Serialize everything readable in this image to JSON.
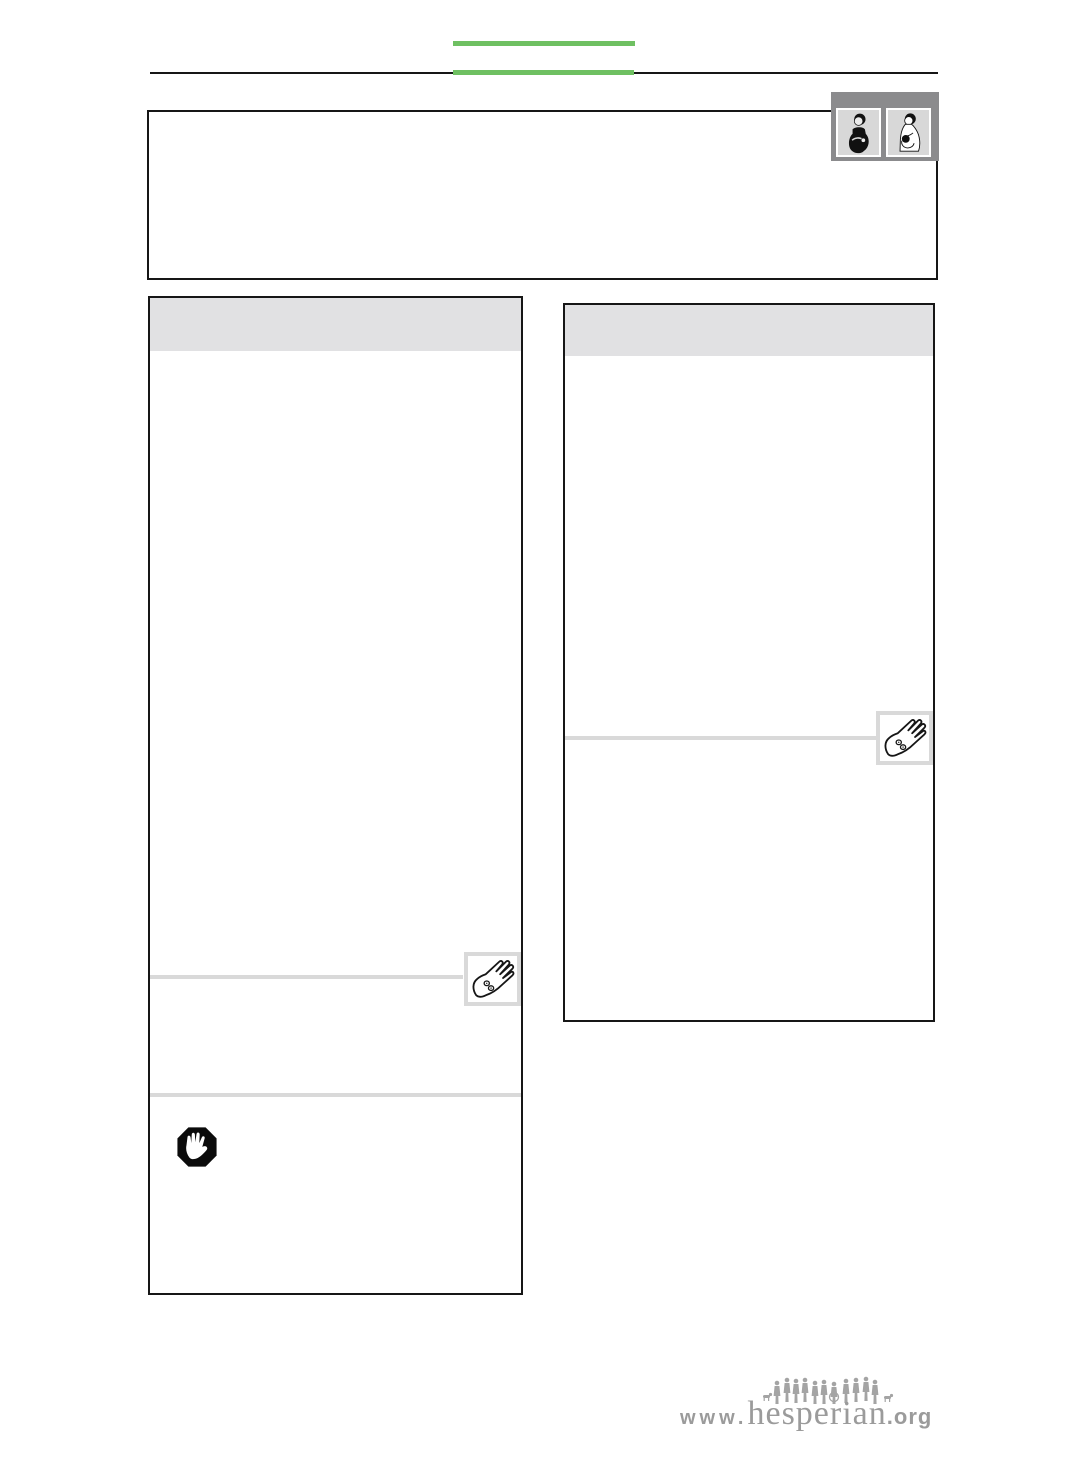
{
  "page": {
    "kind": "blank document page with layout frames",
    "background": "#ffffff"
  },
  "colors": {
    "accent_green": "#6fc062",
    "line_black": "#161616",
    "panel_header_gray": "#e1e1e3",
    "separator_gray": "#d9d9d9",
    "icon_frame_gray": "#d9d9d9",
    "chapter_tab_gray": "#8b8b8d",
    "chapter_tile_gray": "#d8d8d8",
    "logo_gray": "#9b9b9b"
  },
  "chapter_tab": {
    "icons": [
      {
        "name": "pregnant-woman-icon"
      },
      {
        "name": "breastfeeding-woman-icon"
      }
    ]
  },
  "panels": {
    "left": {
      "header_text": "",
      "icons": [
        {
          "name": "hand-with-pills-icon"
        },
        {
          "name": "stop-hand-octagon-icon"
        }
      ]
    },
    "right": {
      "header_text": "",
      "icons": [
        {
          "name": "hand-with-pills-icon"
        }
      ]
    }
  },
  "footer_logo": {
    "www": "www.",
    "name": "hesperian",
    "org": ".org"
  }
}
